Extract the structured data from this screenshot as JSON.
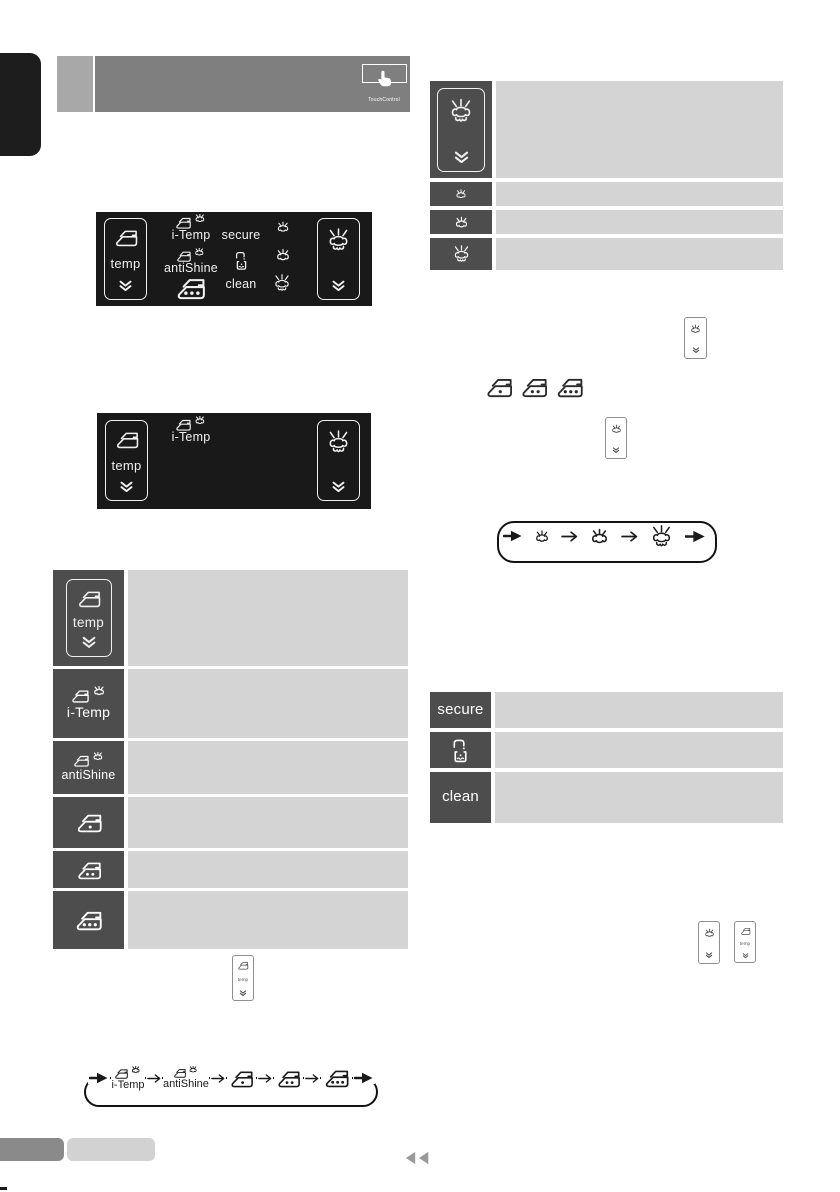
{
  "colors": {
    "panel_bg": "#191919",
    "icon_cell_dark": "#4d4d4d",
    "content_cell_light": "#d4d4d4",
    "header_bar": "#7f7f7f",
    "header_square": "#a8a8a8",
    "tab_black": "#1d1d1d",
    "footer_dark_pill": "#8a8a8a",
    "footer_light_pill": "#d2d2d2",
    "footer_arrows": "#9a9a9a"
  },
  "header": {
    "touchcontrol_label": "TouchControl"
  },
  "labels": {
    "temp": "temp",
    "i_temp": "i-Temp",
    "antishine": "antiShine",
    "secure": "secure",
    "clean": "clean"
  },
  "panel_display": {
    "left_button": "temp-select-button",
    "right_button": "steam-select-button",
    "indicators": [
      "i-Temp",
      "antiShine",
      "secure",
      "clean",
      "calc",
      "iron-3-dot",
      "steam-level-1",
      "steam-level-2",
      "steam-level-3"
    ]
  },
  "left_table": {
    "rows": [
      {
        "icon": "temp-button",
        "text": ""
      },
      {
        "icon": "iron-steam",
        "label_key": "i_temp",
        "text": ""
      },
      {
        "icon": "iron-steam",
        "label_key": "antishine",
        "text": ""
      },
      {
        "icon": "iron-1-dot",
        "text": ""
      },
      {
        "icon": "iron-2-dot",
        "text": ""
      },
      {
        "icon": "iron-3-dot",
        "text": ""
      }
    ]
  },
  "steam_table": {
    "rows": [
      {
        "icon": "steam-button",
        "text": ""
      },
      {
        "icon": "steam-level-1",
        "text": ""
      },
      {
        "icon": "steam-level-2",
        "text": ""
      },
      {
        "icon": "steam-level-3",
        "text": ""
      }
    ]
  },
  "function_table": {
    "rows": [
      {
        "label_key": "secure",
        "text": ""
      },
      {
        "icon": "calc",
        "text": ""
      },
      {
        "label_key": "clean",
        "text": ""
      }
    ]
  },
  "temp_cycle_sequence": [
    "i-Temp",
    "antiShine",
    "iron-1-dot",
    "iron-2-dot",
    "iron-3-dot"
  ],
  "steam_cycle_sequence": [
    "steam-level-1",
    "steam-level-2",
    "steam-level-3"
  ]
}
